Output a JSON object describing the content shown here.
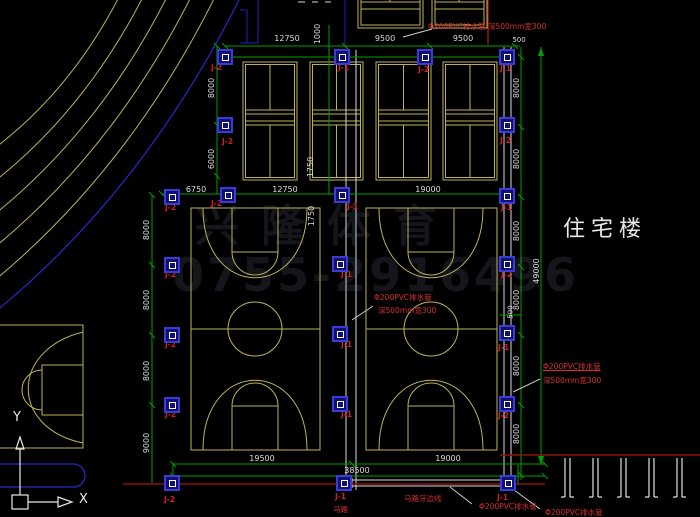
{
  "scene": "residential sports-court site drainage plan (CAD)",
  "colors": {
    "background": "#000000",
    "court_lines": "#bdb356",
    "dimension_green": "#00a000",
    "annotation_red": "#d62f2f",
    "road_dark_red": "#8a1010",
    "drain_symbol_blue": "#3b3bd8",
    "white_lines": "#d8d8d8",
    "road_blue": "#2828c8"
  },
  "building_label": "住宅楼",
  "axis_labels": {
    "x": "X",
    "y": "Y"
  },
  "watermark": {
    "line1": "兴隆体育",
    "line2": "0755-2916496"
  },
  "labels": {
    "dims": [
      {
        "t": "12750",
        "x": 287,
        "y": 35
      },
      {
        "t": "9500",
        "x": 385,
        "y": 35
      },
      {
        "t": "9500",
        "x": 463,
        "y": 35
      },
      {
        "t": "500",
        "x": 519,
        "y": 37,
        "s": 7
      },
      {
        "t": "6750",
        "x": 196,
        "y": 186
      },
      {
        "t": "12750",
        "x": 285,
        "y": 186
      },
      {
        "t": "19000",
        "x": 428,
        "y": 186
      },
      {
        "t": "19500",
        "x": 262,
        "y": 455
      },
      {
        "t": "19000",
        "x": 448,
        "y": 455
      },
      {
        "t": "38500",
        "x": 357,
        "y": 467
      },
      {
        "t": "1000",
        "x": 318,
        "y": 34,
        "rot": true
      },
      {
        "t": "8000",
        "x": 212,
        "y": 88,
        "rot": true
      },
      {
        "t": "6000",
        "x": 212,
        "y": 159,
        "rot": true
      },
      {
        "t": "1750",
        "x": 311,
        "y": 167,
        "rot": true
      },
      {
        "t": "1750",
        "x": 312,
        "y": 216,
        "rot": true
      },
      {
        "t": "8000",
        "x": 147,
        "y": 230,
        "rot": true
      },
      {
        "t": "8000",
        "x": 147,
        "y": 300,
        "rot": true
      },
      {
        "t": "8000",
        "x": 147,
        "y": 371,
        "rot": true
      },
      {
        "t": "9000",
        "x": 147,
        "y": 443,
        "rot": true
      },
      {
        "t": "8000",
        "x": 517,
        "y": 88,
        "rot": true
      },
      {
        "t": "8000",
        "x": 517,
        "y": 159,
        "rot": true
      },
      {
        "t": "8000",
        "x": 517,
        "y": 231,
        "rot": true
      },
      {
        "t": "8000",
        "x": 517,
        "y": 300,
        "rot": true
      },
      {
        "t": "8000",
        "x": 517,
        "y": 366,
        "rot": true
      },
      {
        "t": "8000",
        "x": 517,
        "y": 434,
        "rot": true
      },
      {
        "t": "500",
        "x": 511,
        "y": 312,
        "rot": true,
        "s": 7
      },
      {
        "t": "49000",
        "x": 537,
        "y": 271,
        "rot": true
      }
    ],
    "red_notes": [
      {
        "t": "Φ200PVC排水管 深500mm宽300",
        "x": 428,
        "y": 23
      },
      {
        "t": "Φ200PVC排水管",
        "x": 374,
        "y": 294
      },
      {
        "t": "深500mm宽300",
        "x": 378,
        "y": 307
      },
      {
        "t": "Φ200PVC排水管",
        "x": 543,
        "y": 363,
        "u": true
      },
      {
        "t": "深500mm宽300",
        "x": 543,
        "y": 377
      },
      {
        "t": "马路牙边线",
        "x": 404,
        "y": 495
      },
      {
        "t": "马路",
        "x": 333,
        "y": 506
      },
      {
        "t": "Φ200PVC排水管",
        "x": 479,
        "y": 503
      },
      {
        "t": "Φ200PVC排水管",
        "x": 545,
        "y": 509
      }
    ],
    "drain_tags": [
      {
        "t": "J-2",
        "x": 211,
        "y": 64
      },
      {
        "t": "J-1",
        "x": 338,
        "y": 64
      },
      {
        "t": "J-2",
        "x": 418,
        "y": 66
      },
      {
        "t": "J-1",
        "x": 500,
        "y": 65
      },
      {
        "t": "J-2",
        "x": 222,
        "y": 138
      },
      {
        "t": "J-2",
        "x": 500,
        "y": 137
      },
      {
        "t": "J-2",
        "x": 165,
        "y": 204
      },
      {
        "t": "J-2",
        "x": 211,
        "y": 200
      },
      {
        "t": "J-1",
        "x": 347,
        "y": 203
      },
      {
        "t": "J-1",
        "x": 501,
        "y": 204
      },
      {
        "t": "J-2",
        "x": 165,
        "y": 271
      },
      {
        "t": "J-1",
        "x": 341,
        "y": 271
      },
      {
        "t": "J-2",
        "x": 501,
        "y": 271
      },
      {
        "t": "J-2",
        "x": 165,
        "y": 341
      },
      {
        "t": "J-1",
        "x": 341,
        "y": 341
      },
      {
        "t": "J-1",
        "x": 498,
        "y": 344
      },
      {
        "t": "J-2",
        "x": 165,
        "y": 411
      },
      {
        "t": "J-1",
        "x": 341,
        "y": 411
      },
      {
        "t": "J-2",
        "x": 498,
        "y": 412
      },
      {
        "t": "J-2",
        "x": 164,
        "y": 496
      },
      {
        "t": "J-1",
        "x": 335,
        "y": 493
      },
      {
        "t": "J-1",
        "x": 497,
        "y": 494
      }
    ],
    "basins": [
      {
        "x": 225,
        "y": 57
      },
      {
        "x": 342,
        "y": 57
      },
      {
        "x": 425,
        "y": 57
      },
      {
        "x": 507,
        "y": 57
      },
      {
        "x": 225,
        "y": 125
      },
      {
        "x": 507,
        "y": 125
      },
      {
        "x": 172,
        "y": 197
      },
      {
        "x": 228,
        "y": 195
      },
      {
        "x": 342,
        "y": 195
      },
      {
        "x": 507,
        "y": 196
      },
      {
        "x": 172,
        "y": 265
      },
      {
        "x": 340,
        "y": 264
      },
      {
        "x": 507,
        "y": 264
      },
      {
        "x": 172,
        "y": 335
      },
      {
        "x": 340,
        "y": 334
      },
      {
        "x": 507,
        "y": 333
      },
      {
        "x": 172,
        "y": 405
      },
      {
        "x": 340,
        "y": 404
      },
      {
        "x": 507,
        "y": 404
      },
      {
        "x": 172,
        "y": 483
      },
      {
        "x": 344,
        "y": 483
      },
      {
        "x": 508,
        "y": 483
      }
    ]
  }
}
